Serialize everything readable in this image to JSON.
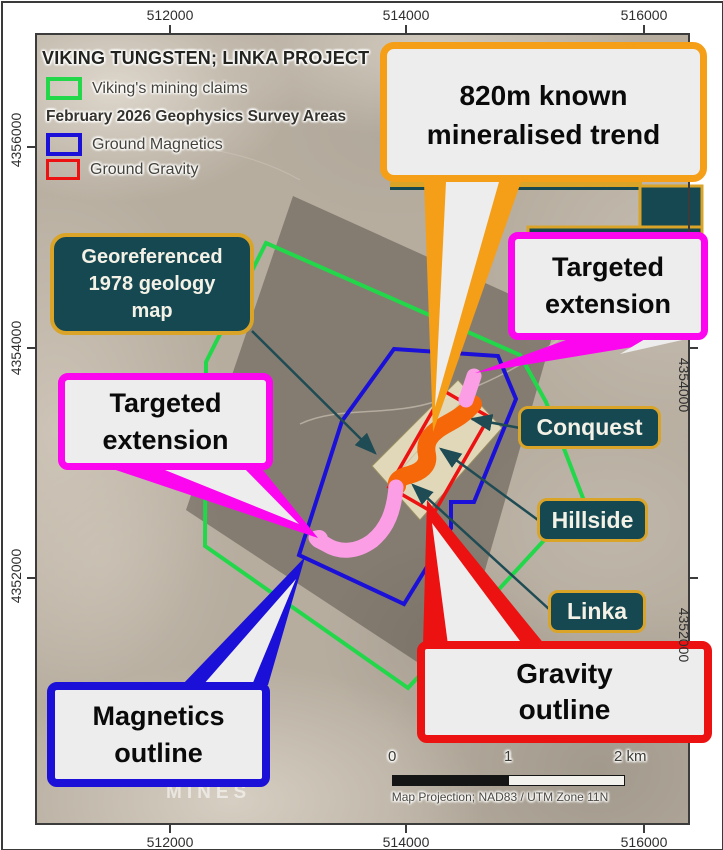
{
  "figure": {
    "title": "VIKING TUNGSTEN; LINKA PROJECT",
    "legend": {
      "claims_label": "Viking's mining claims",
      "survey_header": "February 2026 Geophysics Survey Areas",
      "magnetics_label": "Ground Magnetics",
      "gravity_label": "Ground Gravity"
    },
    "callouts": {
      "trend_lines": [
        "820m known",
        "mineralised trend"
      ],
      "targeted_extension_lines": [
        "Targeted",
        "extension"
      ],
      "georef_lines": [
        "Georeferenced",
        "1978 geology",
        "map"
      ],
      "magnetics_outline_lines": [
        "Magnetics",
        "outline"
      ],
      "gravity_outline_lines": [
        "Gravity",
        "outline"
      ]
    },
    "places": {
      "conquest": "Conquest",
      "hillside": "Hillside",
      "linka": "Linka"
    },
    "axes": {
      "top": [
        "512000",
        "514000",
        "516000"
      ],
      "bottom": [
        "512000",
        "514000",
        "516000"
      ],
      "left": [
        "4356000",
        "4354000",
        "4352000"
      ],
      "right": [
        "4354000",
        "4352000"
      ]
    },
    "scalebar": {
      "start": "0",
      "middle": "1",
      "end": "2 km"
    },
    "projection_note": "Map Projection; NAD83 / UTM Zone 11N",
    "watermark": "MINES",
    "colors": {
      "claims_outline": "#23D74A",
      "magnetics_outline": "#1A10D8",
      "gravity_outline": "#EC1212",
      "mineralised_trend": "#F56708",
      "targeted_extension_trend": "#FB9EE6",
      "trend_callout_border": "#F59E18",
      "extension_callout_border": "#FC06F0",
      "place_label_bg": "#164852",
      "place_label_border": "#D9A428",
      "callout_bg": "#EDEDED"
    }
  }
}
